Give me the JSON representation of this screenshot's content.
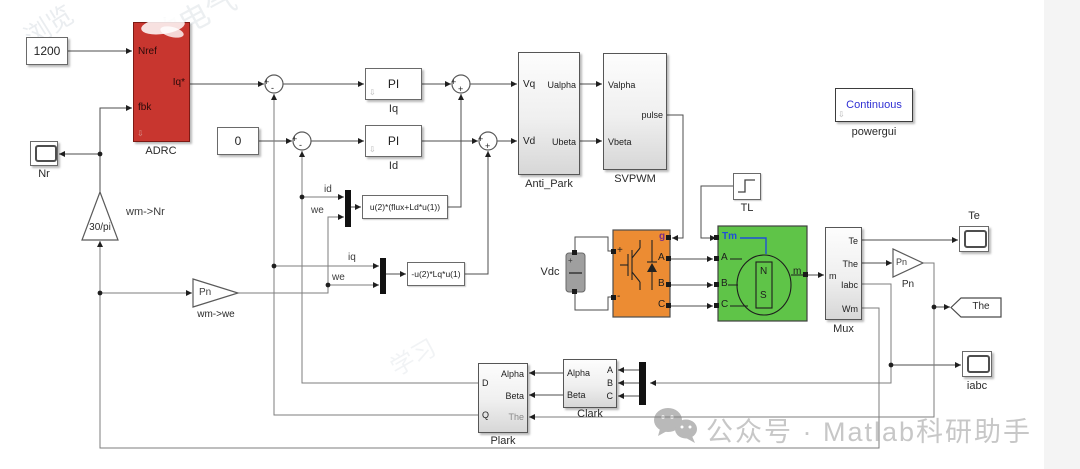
{
  "blocks": {
    "speed_ref": {
      "value": "1200"
    },
    "adrc": {
      "label": "ADRC",
      "port_nref": "Nref",
      "port_fbk": "fbk",
      "port_iq_ref": "Iq*"
    },
    "scope_nr": {
      "label": "Nr"
    },
    "gain_rpm": {
      "gain": "30/pi",
      "label": "wm->Nr"
    },
    "id_ref": {
      "value": "0"
    },
    "pi_iq": {
      "text": "PI",
      "label": "Iq"
    },
    "pi_id": {
      "text": "PI",
      "label": "Id"
    },
    "fcn_q": {
      "expr": "u(2)*(flux+Ld*u(1))"
    },
    "fcn_d": {
      "expr": "-u(2)*Lq*u(1)"
    },
    "gain_we": {
      "gain": "Pn",
      "label": "wm->we"
    },
    "anti_park": {
      "label": "Anti_Park",
      "port_vq": "Vq",
      "port_vd": "Vd",
      "port_ualpha": "Ualpha",
      "port_ubeta": "Ubeta"
    },
    "svpwm": {
      "label": "SVPWM",
      "port_valpha": "Valpha",
      "port_vbeta": "Vbeta",
      "port_pulse": "pulse"
    },
    "step_tl": {
      "label": "TL"
    },
    "vdc": {
      "label": "Vdc",
      "plus": "+"
    },
    "inverter": {
      "port_g": "g",
      "port_plus": "+",
      "port_minus": "-",
      "port_a": "A",
      "port_b": "B",
      "port_c": "C"
    },
    "pmsm": {
      "port_tm": "Tm",
      "port_a": "A",
      "port_b": "B",
      "port_c": "C",
      "port_m": "m",
      "north": "N",
      "south": "S"
    },
    "mux": {
      "label": "Mux",
      "port_m": "m",
      "port_te": "Te",
      "port_the": "The",
      "port_iabc": "Iabc",
      "port_wm": "Wm"
    },
    "gain_pn": {
      "gain": "Pn",
      "label": "Pn"
    },
    "scope_te": {
      "label": "Te"
    },
    "goto_the": {
      "label": "The"
    },
    "scope_iabc": {
      "label": "iabc"
    },
    "clark": {
      "label": "Clark",
      "port_alpha": "Alpha",
      "port_beta": "Beta",
      "port_a": "A",
      "port_b": "B",
      "port_c": "C"
    },
    "plark": {
      "label": "Plark",
      "port_d": "D",
      "port_q": "Q",
      "port_alpha": "Alpha",
      "port_beta": "Beta",
      "port_the": "The"
    },
    "powergui": {
      "text": "Continuous",
      "label": "powergui"
    }
  },
  "signals": {
    "id": "id",
    "we": "we",
    "iq": "iq"
  },
  "signs": {
    "plus": "+",
    "minus": "-"
  },
  "glyphs": {
    "mask_badge": "⇩"
  },
  "watermark": {
    "brand_text": "公众号 · Matlab科研助手"
  },
  "background_fragments": [
    {
      "text": "浏览"
    },
    {
      "text": "的电气"
    },
    {
      "text": "学习"
    }
  ],
  "colors": {
    "adrc_red": "#c8362f",
    "inverter_orange": "#ec8c33",
    "pmsm_green": "#5fc448",
    "powergui_blue": "#2f2fd3",
    "tm_blue": "#1f4fd8",
    "g_purple": "#7b2d86"
  }
}
